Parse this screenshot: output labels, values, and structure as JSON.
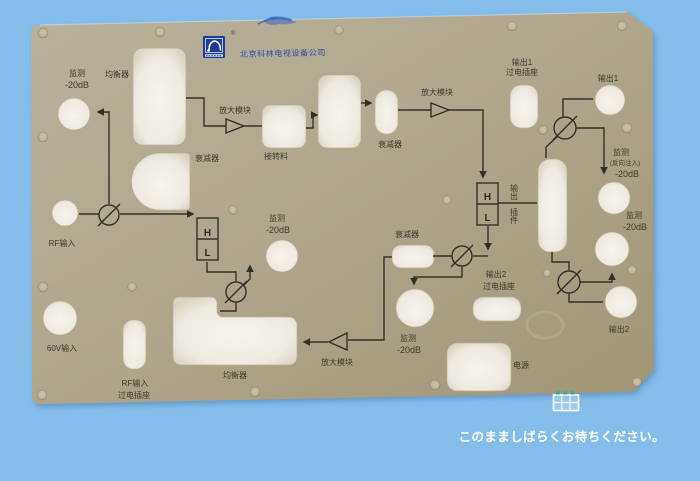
{
  "overlay": {
    "wait_text": "このまましばらくお待ちください。"
  },
  "panel": {
    "company": "北京科林电视设备公司",
    "trademark": "®",
    "labels": {
      "monitor_tl1": "监测",
      "monitor_tl2": "-20dB",
      "equalizer_top": "均衡器",
      "amp_module_l": "放大模块",
      "connector": "接转料",
      "attenuator_top": "衰减器",
      "monitor_mid1": "监测",
      "monitor_mid2": "-20dB",
      "attenuator_s": "衰减器",
      "amp_module_r": "放大模块",
      "out1_sock1": "输出1",
      "out1_sock2": "过电插座",
      "out1": "输出1",
      "monitor_rev1": "监测",
      "monitor_rev2": "(反向注入)",
      "monitor_rev3": "-20dB",
      "monitor_r2a": "监测",
      "monitor_r2b": "-20dB",
      "h1": "H",
      "l1": "L",
      "h2": "H",
      "l2": "L",
      "out_plug1": "输出",
      "out_plug2": "插件",
      "attenuator_mid": "衰减器",
      "out2_sock1": "输出2",
      "out2_sock2": "过电插座",
      "out2": "输出2",
      "monitor_bot1": "监测",
      "monitor_bot2": "-20dB",
      "power": "电源",
      "equalizer_bottom": "均衡器",
      "amp_module_b": "放大模块",
      "rf_in": "RF输入",
      "v60_in": "60V输入",
      "rf_sock1": "RF输入",
      "rf_sock2": "过电插座"
    }
  },
  "colors": {
    "background": "#84bdea",
    "panel": "#b0a78d",
    "cutout": "#ece8df",
    "line": "#32302a",
    "label_text": "#3c392c",
    "logo_blue": "#1d3c9c",
    "company_text": "#2d4cab",
    "overlay_text": "#ffffff",
    "icon_teal": "#27aaa2"
  }
}
